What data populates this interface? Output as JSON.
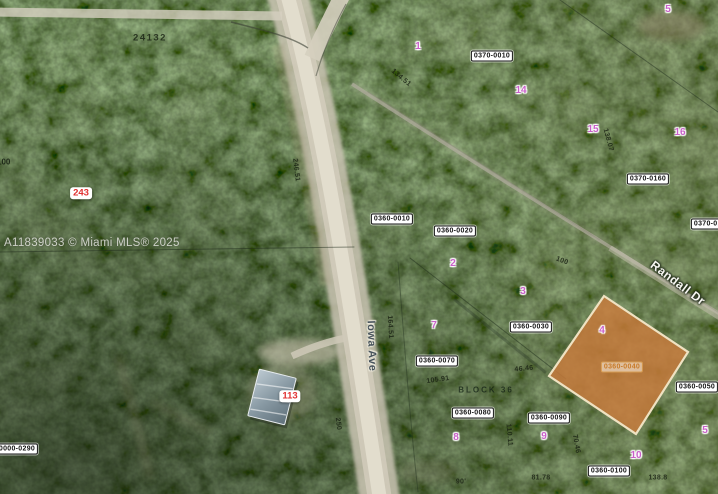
{
  "image_type": "aerial-parcel-map",
  "watermark": "A11839033 © Miami MLS® 2025",
  "plat_number": "24132",
  "block_label": "BLOCK 36",
  "edge_number": "100",
  "colors": {
    "subject_parcel_fill": "#c67a3c",
    "subject_parcel_border": "#efe2c2",
    "lot_number_pink": "#c95fc9",
    "red_marker": "#e03131",
    "road": "#e3decf",
    "forest_base": "#2f3d2a"
  },
  "subject_parcel": {
    "id": "0360-0040",
    "lot": "4"
  },
  "map_overlay": {
    "streets": [
      {
        "text": "Iowa Ave",
        "x": 371,
        "y": 346,
        "rot": 88,
        "theme": "dark"
      },
      {
        "text": "Randall Dr",
        "x": 678,
        "y": 283,
        "rot": 37,
        "theme": "light"
      }
    ],
    "parcel_ids": [
      {
        "text": "0370-0010",
        "x": 492,
        "y": 56,
        "variant": "default"
      },
      {
        "text": "0370-0160",
        "x": 648,
        "y": 179,
        "variant": "default"
      },
      {
        "text": "0370-0170",
        "x": 712,
        "y": 224,
        "variant": "default"
      },
      {
        "text": "0360-0010",
        "x": 392,
        "y": 219,
        "variant": "default"
      },
      {
        "text": "0360-0020",
        "x": 455,
        "y": 231,
        "variant": "default"
      },
      {
        "text": "0360-0030",
        "x": 531,
        "y": 327,
        "variant": "default"
      },
      {
        "text": "0360-0070",
        "x": 437,
        "y": 361,
        "variant": "default"
      },
      {
        "text": "0360-0080",
        "x": 473,
        "y": 413,
        "variant": "default"
      },
      {
        "text": "0360-0090",
        "x": 549,
        "y": 418,
        "variant": "default"
      },
      {
        "text": "0360-0040",
        "x": 622,
        "y": 367,
        "variant": "subject"
      },
      {
        "text": "0360-0050",
        "x": 697,
        "y": 387,
        "variant": "default"
      },
      {
        "text": "0360-0100",
        "x": 609,
        "y": 471,
        "variant": "default"
      },
      {
        "text": "0000-0290",
        "x": 17,
        "y": 449,
        "variant": "default"
      }
    ],
    "lot_numbers": [
      {
        "text": "5",
        "x": 668,
        "y": 10
      },
      {
        "text": "1",
        "x": 418,
        "y": 47
      },
      {
        "text": "14",
        "x": 521,
        "y": 91
      },
      {
        "text": "15",
        "x": 593,
        "y": 130
      },
      {
        "text": "16",
        "x": 680,
        "y": 133
      },
      {
        "text": "2",
        "x": 453,
        "y": 264
      },
      {
        "text": "3",
        "x": 523,
        "y": 292
      },
      {
        "text": "7",
        "x": 434,
        "y": 326
      },
      {
        "text": "4",
        "x": 602,
        "y": 331
      },
      {
        "text": "8",
        "x": 456,
        "y": 438
      },
      {
        "text": "9",
        "x": 544,
        "y": 437
      },
      {
        "text": "5",
        "x": 705,
        "y": 431
      },
      {
        "text": "10",
        "x": 636,
        "y": 456
      }
    ],
    "red_markers": [
      {
        "text": "243",
        "x": 81,
        "y": 193
      },
      {
        "text": "113",
        "x": 290,
        "y": 396
      }
    ],
    "dimensions": [
      {
        "text": "246.51",
        "x": 296,
        "y": 170,
        "rot": 83
      },
      {
        "text": "134.51",
        "x": 401,
        "y": 78,
        "rot": 40
      },
      {
        "text": "138.07",
        "x": 608,
        "y": 140,
        "rot": 75
      },
      {
        "text": "100",
        "x": 562,
        "y": 261,
        "rot": 20
      },
      {
        "text": "164.51",
        "x": 390,
        "y": 327,
        "rot": 87
      },
      {
        "text": "250",
        "x": 338,
        "y": 424,
        "rot": 83
      },
      {
        "text": "105.91",
        "x": 438,
        "y": 380,
        "rot": -8
      },
      {
        "text": "46.46",
        "x": 524,
        "y": 369,
        "rot": -5
      },
      {
        "text": "110.11",
        "x": 509,
        "y": 435,
        "rot": 85
      },
      {
        "text": "70.46",
        "x": 576,
        "y": 444,
        "rot": 80
      },
      {
        "text": "90'",
        "x": 461,
        "y": 482,
        "rot": 0
      },
      {
        "text": "81.78",
        "x": 541,
        "y": 478,
        "rot": 0
      },
      {
        "text": "138.8",
        "x": 658,
        "y": 478,
        "rot": 0
      }
    ]
  }
}
